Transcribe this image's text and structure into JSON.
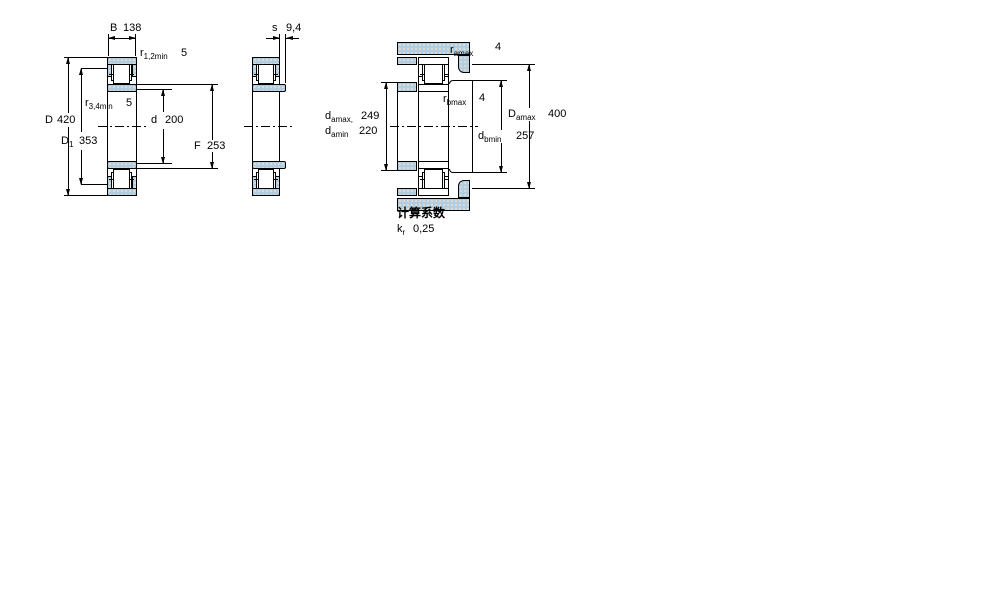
{
  "v1": {
    "B": {
      "base": "B",
      "value": "138"
    },
    "r12": {
      "base": "r",
      "sub": "1,2min",
      "value": "5"
    },
    "r34": {
      "base": "r",
      "sub": "3,4min",
      "value": "5"
    },
    "D": {
      "base": "D",
      "value": "420"
    },
    "D1": {
      "base": "D",
      "sub": "1",
      "value": "353"
    },
    "d": {
      "base": "d",
      "value": "200"
    },
    "F": {
      "base": "F",
      "value": "253"
    }
  },
  "v2": {
    "s": {
      "base": "s",
      "value": "9,4"
    }
  },
  "v3": {
    "ra": {
      "base": "r",
      "sub": "amax",
      "value": "4"
    },
    "rb": {
      "base": "r",
      "sub": "bmax",
      "value": "4"
    },
    "damax": {
      "base": "d",
      "sub": "amax,",
      "value": "249"
    },
    "damin": {
      "base": "d",
      "sub": "amin",
      "value": "220"
    },
    "Damax": {
      "base": "D",
      "sub": "amax",
      "value": "400"
    },
    "dbmin": {
      "base": "d",
      "sub": "bmin",
      "value": "257"
    }
  },
  "calc": {
    "title": "计算系数",
    "kr_base": "k",
    "kr_sub": "r",
    "kr_value": "0,25"
  },
  "colors": {
    "hatch_fill": "#b2cde0",
    "hatch_dot": "#e7e0d3",
    "line": "#000000"
  }
}
